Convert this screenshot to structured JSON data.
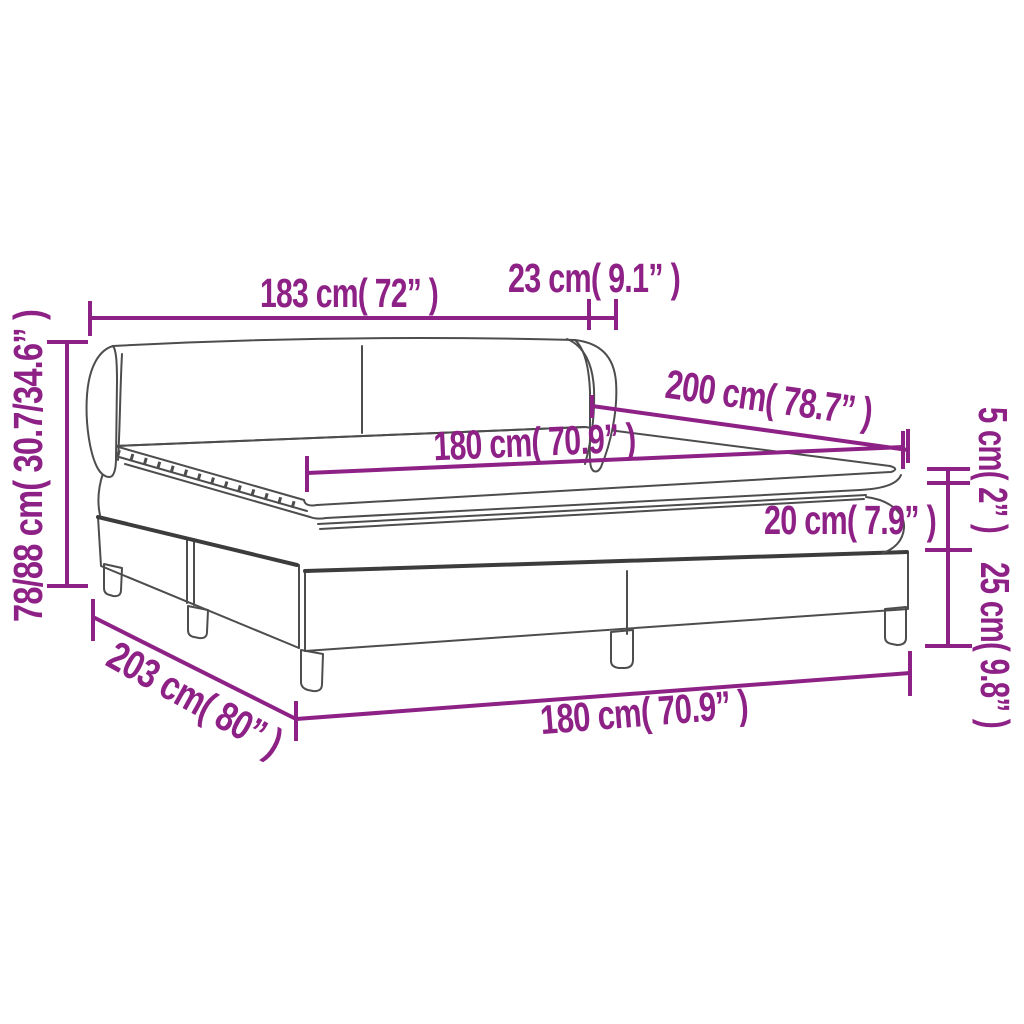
{
  "diagram": {
    "subject": "box-spring-bed-with-headboard-dimension-diagram",
    "colors": {
      "dimension_accent": "#8E2186",
      "line_art": "#4d4d4d",
      "background": "#ffffff"
    },
    "dims": {
      "header_width": "183 cm( 72” )",
      "wing_depth": "23 cm( 9.1” )",
      "total_height": "78/88 cm( 30.7/34.6” )",
      "bed_length_top": "200 cm( 78.7” )",
      "mattress_width_top": "180 cm( 70.9” )",
      "mattress_thickness": "20 cm( 7.9” )",
      "topper_thickness": "5 cm( 2” )",
      "base_height": "25 cm( 9.8” )",
      "base_length": "203 cm( 80” )",
      "base_width_bottom": "180 cm( 70.9” )"
    }
  }
}
